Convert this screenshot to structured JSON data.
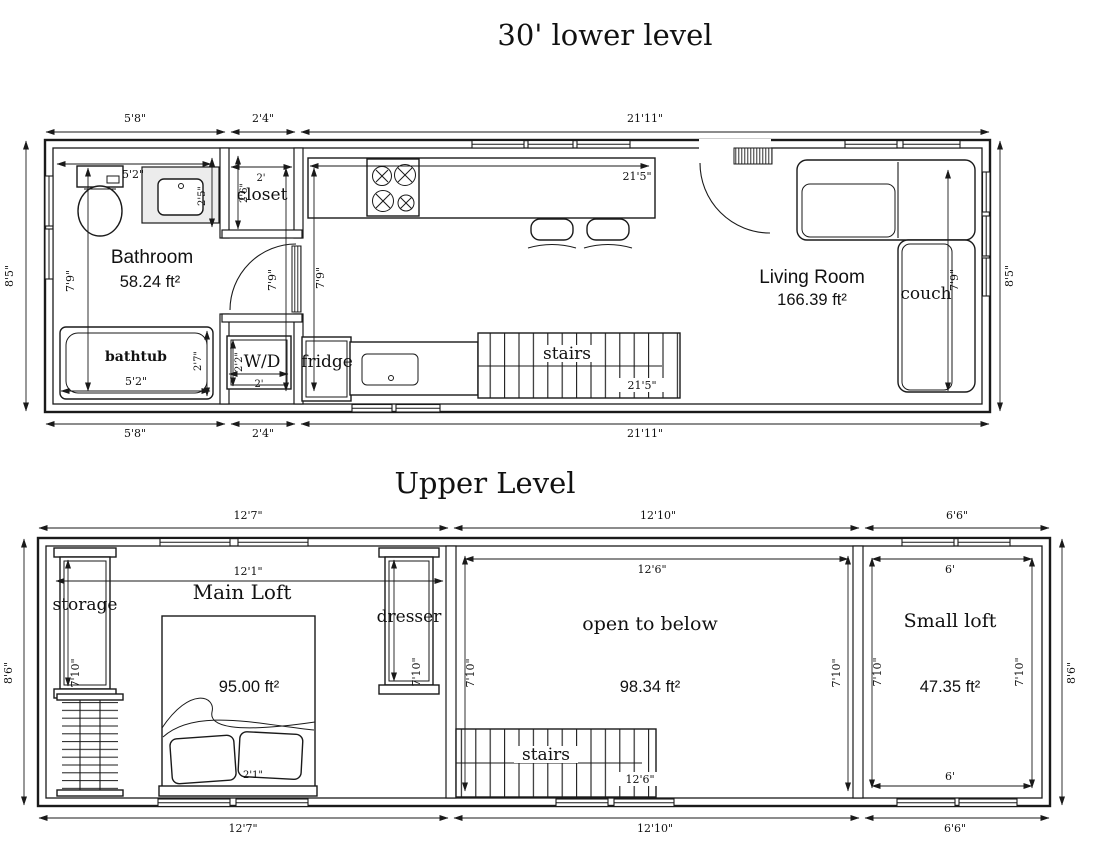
{
  "page": {
    "background": "#ffffff",
    "line_color": "#1a1a1a"
  },
  "lower": {
    "title": "30'  lower level",
    "dims": {
      "top": [
        "5'8\"",
        "2'4\"",
        "21'11\""
      ],
      "bottom": [
        "5'8\"",
        "2'4\"",
        "21'11\""
      ],
      "left": "8'5\"",
      "right": "8'5\"",
      "bath_height": "7'9\"",
      "hall_left": "7'9\"",
      "hall_right": "7'9\"",
      "living_height": "7'9\"",
      "vanity_width": "5'2\"",
      "vanity_depth": "2'5\"",
      "closet_width": "2'",
      "closet_depth": "2'6\"",
      "wd_width": "2'",
      "wd_depth": "2'2\"",
      "tub_width": "5'2\"",
      "tub_depth": "2'7\"",
      "counter_length": "21'5\"",
      "stairs_length": "21'5\""
    },
    "bathroom": {
      "name": "Bathroom",
      "area": "58.24 ft²"
    },
    "living": {
      "name": "Living Room",
      "area": "166.39 ft²"
    },
    "labels": {
      "closet": "closet",
      "wd": "W/D",
      "fridge": "fridge",
      "bathtub": "bathtub",
      "stairs": "stairs",
      "couch": "couch"
    }
  },
  "upper": {
    "title": "Upper Level",
    "dims": {
      "top": [
        "12'7\"",
        "12'10\"",
        "6'6\""
      ],
      "bottom": [
        "12'7\"",
        "12'10\"",
        "6'6\""
      ],
      "left": "8'6\"",
      "right": "8'6\"",
      "mainloft_width": "12'1\"",
      "open_top": "12'6\"",
      "open_bottom": "12'6\"",
      "small_top": "6'",
      "small_bottom": "6'",
      "storage_height": "7'10\"",
      "dresser_height": "7'10\"",
      "open_left": "7'10\"",
      "open_right": "7'10\"",
      "small_left": "7'10\"",
      "small_right": "7'10\"",
      "bed_width": "2'1\""
    },
    "mainloft": {
      "name": "Main Loft",
      "area": "95.00 ft²"
    },
    "open": {
      "name": "open to below",
      "area": "98.34 ft²"
    },
    "smallloft": {
      "name": "Small loft",
      "area": "47.35 ft²"
    },
    "labels": {
      "storage": "storage",
      "dresser": "dresser",
      "stairs": "stairs"
    }
  }
}
